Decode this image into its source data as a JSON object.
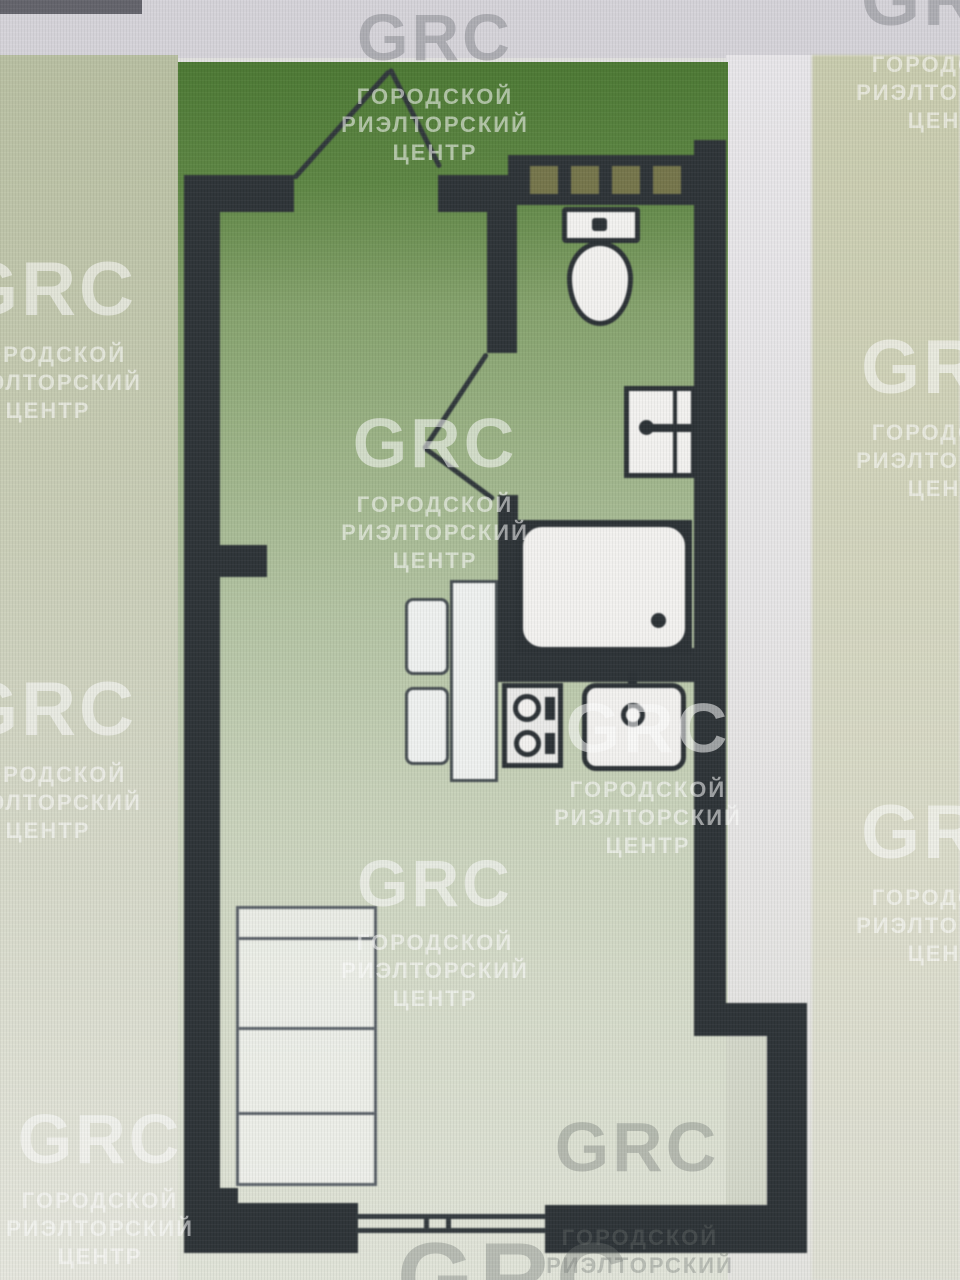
{
  "watermark": {
    "brand": "GRC",
    "line1": "ГОРОДСКОЙ",
    "line2": "РИЭЛТОРСКИЙ",
    "line3": "ЦЕНТР"
  },
  "floor_plan": {
    "fixtures": [
      "toilet",
      "washbasin",
      "bathtub",
      "kitchen-sink",
      "stove",
      "dining-table",
      "chair",
      "bed",
      "window",
      "entry-door",
      "bathroom-door",
      "vent-block"
    ]
  },
  "colors": {
    "wall": "#2c3236",
    "plan_green_top": "#4b7832",
    "plan_green_bottom": "#e2e5da",
    "left_strip": "#b9c0a2",
    "right_strip": "#c9ccae",
    "photo_band": "#d6d4da",
    "fixture_fill": "#f4f3f1",
    "vent_square": "#75754a"
  }
}
